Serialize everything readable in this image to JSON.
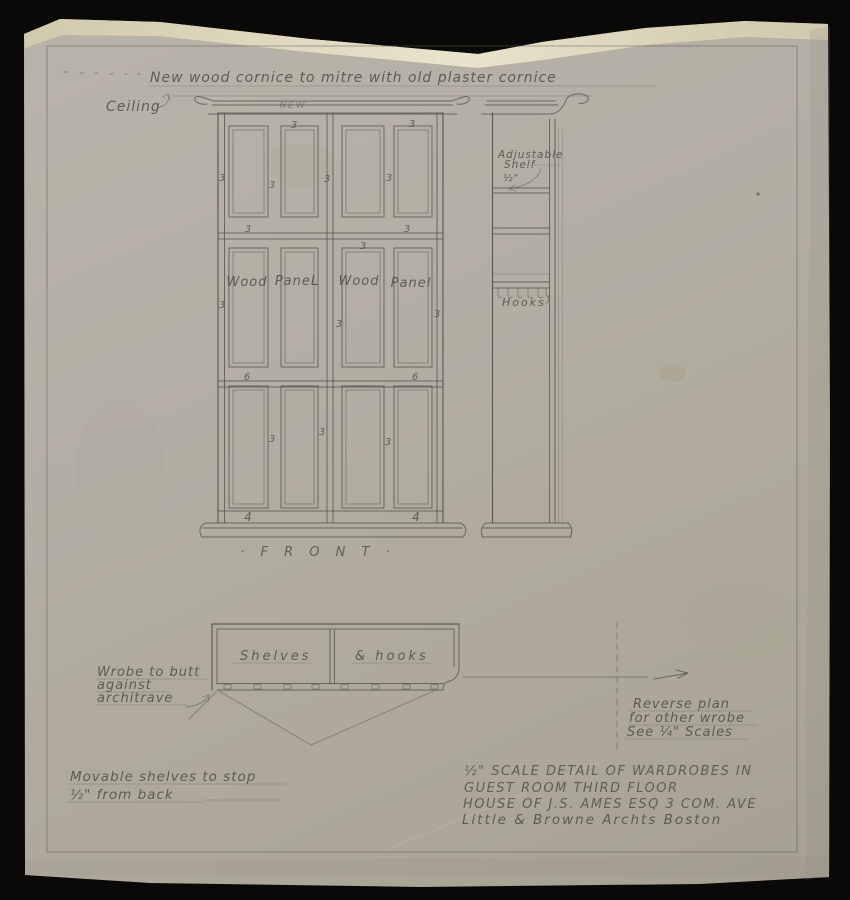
{
  "header": {
    "cornice_note": "New wood cornice to mitre with old plaster cornice",
    "ceiling_label": "Ceiling",
    "new_label": "NEW"
  },
  "dims": {
    "three": "3",
    "four": "4",
    "six": "6"
  },
  "elevation": {
    "panel_word_1": "Wood",
    "panel_word_2": "PaneL",
    "panel_word_3": "Wood",
    "panel_word_4": "Panel",
    "front_caption": "· F R O N T ·"
  },
  "side_section": {
    "adjustable_line1": "Adjustable",
    "adjustable_line2": "Shelf",
    "shelf_dim": "½\"",
    "hooks_label": "Hooks"
  },
  "plan": {
    "left_label": "Shelves",
    "right_label": "& hooks"
  },
  "notes": {
    "wrobe_line1": "Wrobe to butt",
    "wrobe_line2": "against",
    "wrobe_line3": "architrave",
    "movable_line1": "Movable shelves to stop",
    "movable_line2": "½\" from back",
    "reverse_line1": "Reverse plan",
    "reverse_line2": "for other wrobe",
    "reverse_line3": "See ¼\" Scales"
  },
  "title_block": {
    "line1": "½\" SCALE DETAIL OF WARDROBES IN",
    "line2": "GUEST ROOM THIRD FLOOR",
    "line3": "HOUSE OF J.S. AMES ESQ 3 COM. AVE",
    "line4": "Little & Browne Archts Boston"
  },
  "colors": {
    "background": "#0a0908",
    "paper": "#b2ada2",
    "tape": "#ddd6ba",
    "pencil": "#54524b"
  }
}
